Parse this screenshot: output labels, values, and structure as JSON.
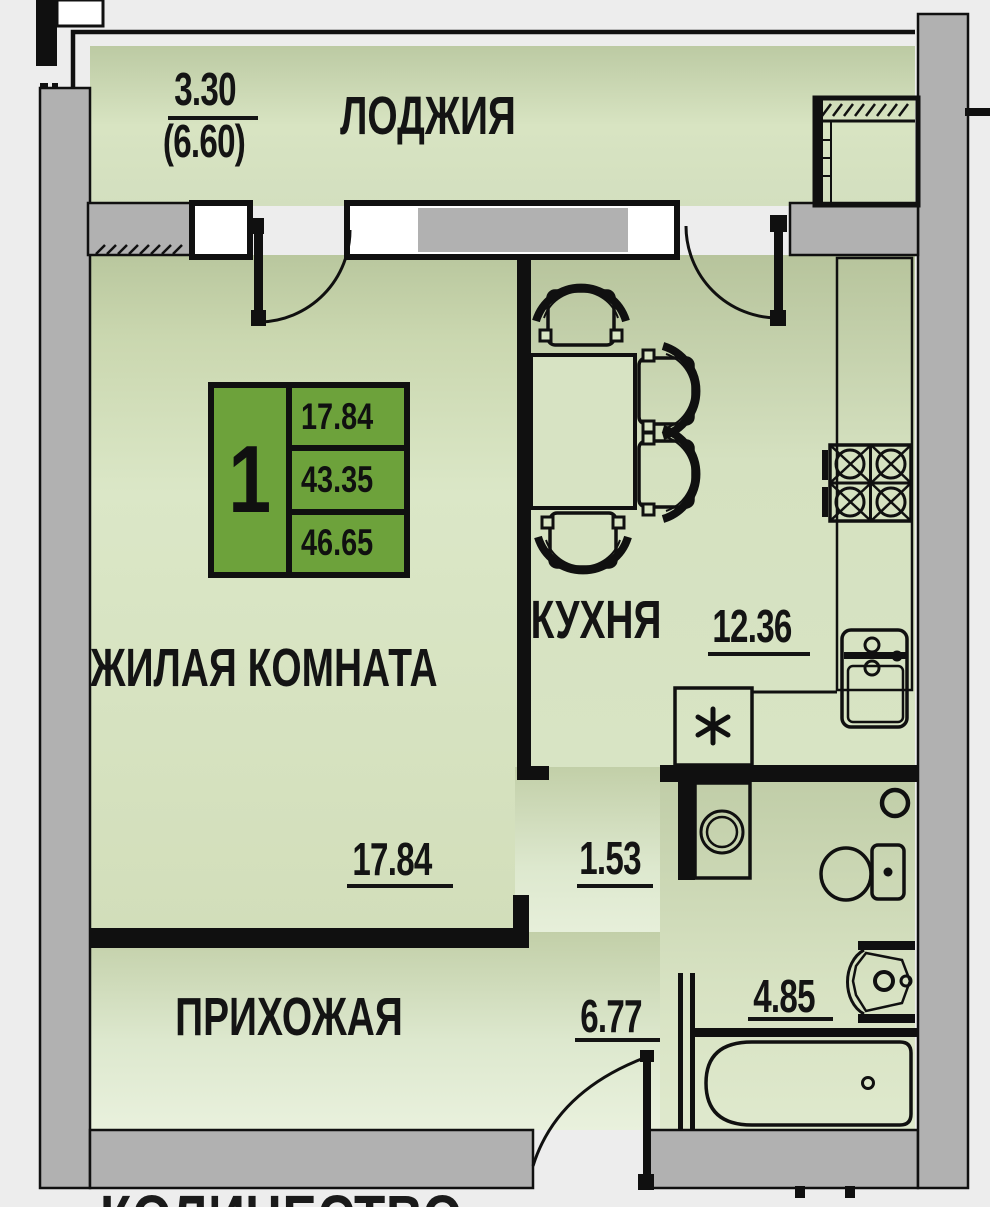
{
  "plan_title_partial": "КОЛИЧЕСТВО",
  "unit_card": {
    "unit_number": "1",
    "rows": [
      "17.84",
      "43.35",
      "46.65"
    ]
  },
  "rooms": {
    "loggia": {
      "label": "ЛОДЖИЯ",
      "dim_numerator": "3.30",
      "dim_denominator": "(6.60)"
    },
    "living": {
      "label": "ЖИЛАЯ КОМНАТА",
      "dim": "17.84"
    },
    "kitchen": {
      "label": "КУХНЯ",
      "dim": "12.36"
    },
    "corridor": {
      "dim": "1.53"
    },
    "hallway": {
      "label": "ПРИХОЖАЯ",
      "dim": "6.77"
    },
    "bathroom": {
      "dim": "4.85"
    }
  },
  "plan_elements": [
    "dining-table",
    "chair",
    "stove",
    "kitchen-sink",
    "refrigerator",
    "washing-machine",
    "toilet",
    "paper-holder",
    "wash-basin",
    "bathtub",
    "balcony-door",
    "entrance-door",
    "window",
    "vent-shaft"
  ],
  "colors": {
    "accent_green": "#6da23b",
    "room_fill": "#d9e5c4",
    "wall_gray": "#b1b1b1",
    "line_black": "#101010",
    "background": "#ededed"
  }
}
